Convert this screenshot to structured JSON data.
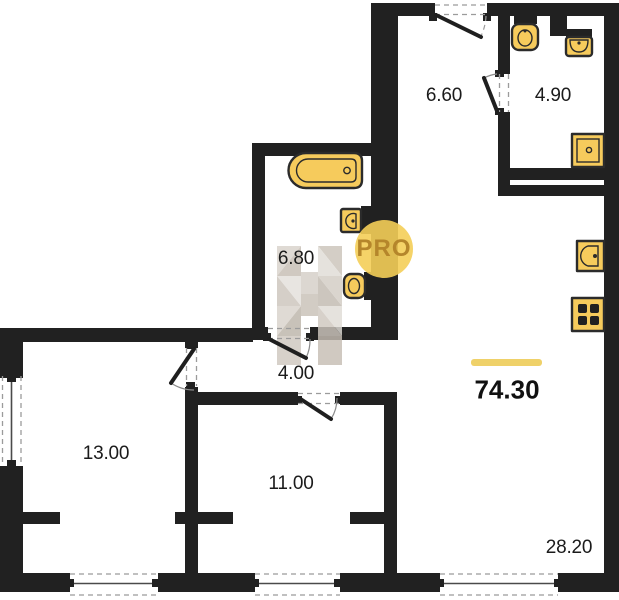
{
  "plan": {
    "title": "apartment-floor-plan",
    "total_area": "74.30",
    "watermark": "PRO",
    "rooms": [
      {
        "name": "hallway",
        "area": "6.60"
      },
      {
        "name": "wc-small",
        "area": "4.90"
      },
      {
        "name": "bathroom",
        "area": "6.80"
      },
      {
        "name": "corridor",
        "area": "4.00"
      },
      {
        "name": "room-left",
        "area": "13.00"
      },
      {
        "name": "room-middle",
        "area": "11.00"
      },
      {
        "name": "living-kitchen",
        "area": "28.20"
      }
    ],
    "fixtures": [
      "bathtub",
      "sink",
      "toilet",
      "toilet",
      "sink",
      "shower",
      "kitchen-sink",
      "stove"
    ]
  },
  "colors": {
    "wall": "#212121",
    "fixture": "#F6CB5C",
    "accent": "#EFD169",
    "watermark_circle": "#F4CE58",
    "watermark_text": "#B5862B"
  }
}
